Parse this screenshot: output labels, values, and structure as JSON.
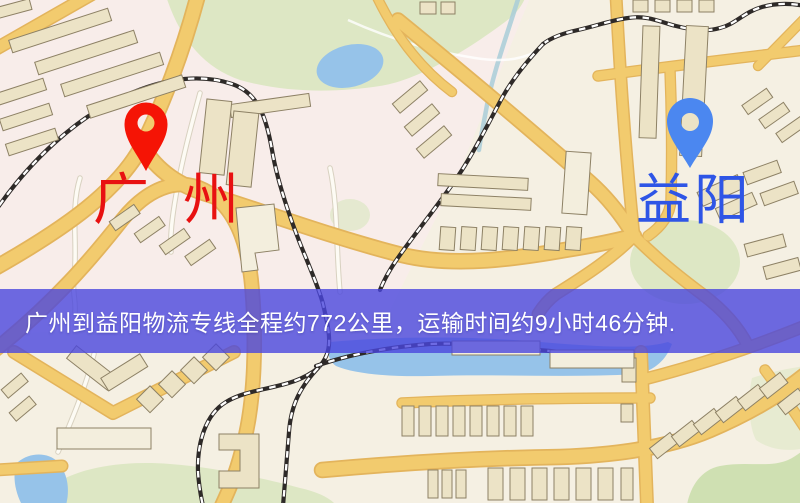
{
  "markers": {
    "origin": {
      "label": "广州",
      "icon": "map-pin-icon"
    },
    "destination": {
      "label": "益阳",
      "icon": "map-pin-icon"
    }
  },
  "banner": {
    "text": "广州到益阳物流专线全程约772公里，运输时间约9小时46分钟."
  },
  "route": {
    "origin": "广州",
    "destination": "益阳",
    "distance_km": 772,
    "duration_hours": 9,
    "duration_minutes": 46
  },
  "colors": {
    "land": "#f5f0e3",
    "land_tint": "#f8ecec",
    "park": "#dde7c4",
    "park_dark": "#cfe0b2",
    "water": "#96c3e9",
    "stream": "#a9ccd8",
    "road_fill": "#f2cb6e",
    "road_casing": "#e3b45c",
    "minor_fill": "#fdfbf4",
    "minor_casing": "#d8d1c0",
    "railway": "#2e2a28",
    "building": "#ece3c6",
    "building_pale": "#f3eedd",
    "building_outline": "#8d8165",
    "banner": "#4a46dd",
    "banner_text": "#ffffff",
    "origin_label": "#e81111",
    "destination_label": "#2e55e6",
    "origin_pin": "#f51405",
    "destination_pin": "#4b87f0"
  }
}
